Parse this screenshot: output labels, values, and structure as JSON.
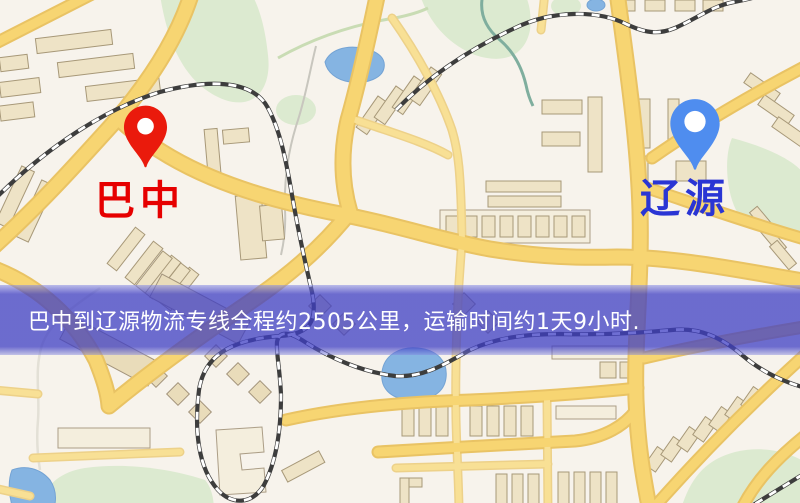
{
  "banner": {
    "text": "巴中到辽源物流专线全程约2505公里，运输时间约1天9小时."
  },
  "markers": {
    "origin": {
      "label": "巴中"
    },
    "destination": {
      "label": "辽源"
    }
  },
  "icons": {
    "origin_pin": "map-pin-icon",
    "destination_pin": "map-pin-icon"
  },
  "theme": {
    "origin_pin": "#ea1a0c",
    "origin_label": "#e60000",
    "destination_pin": "#4f8def",
    "destination_label": "#2a35d4",
    "banner_bg": "rgba(62,62,196,0.75)",
    "banner_text": "#ffffff",
    "road_color": "#f7d572",
    "water_color": "#85b4e2",
    "park_color": "#dcead0",
    "map_background": "#f7f3ec"
  }
}
